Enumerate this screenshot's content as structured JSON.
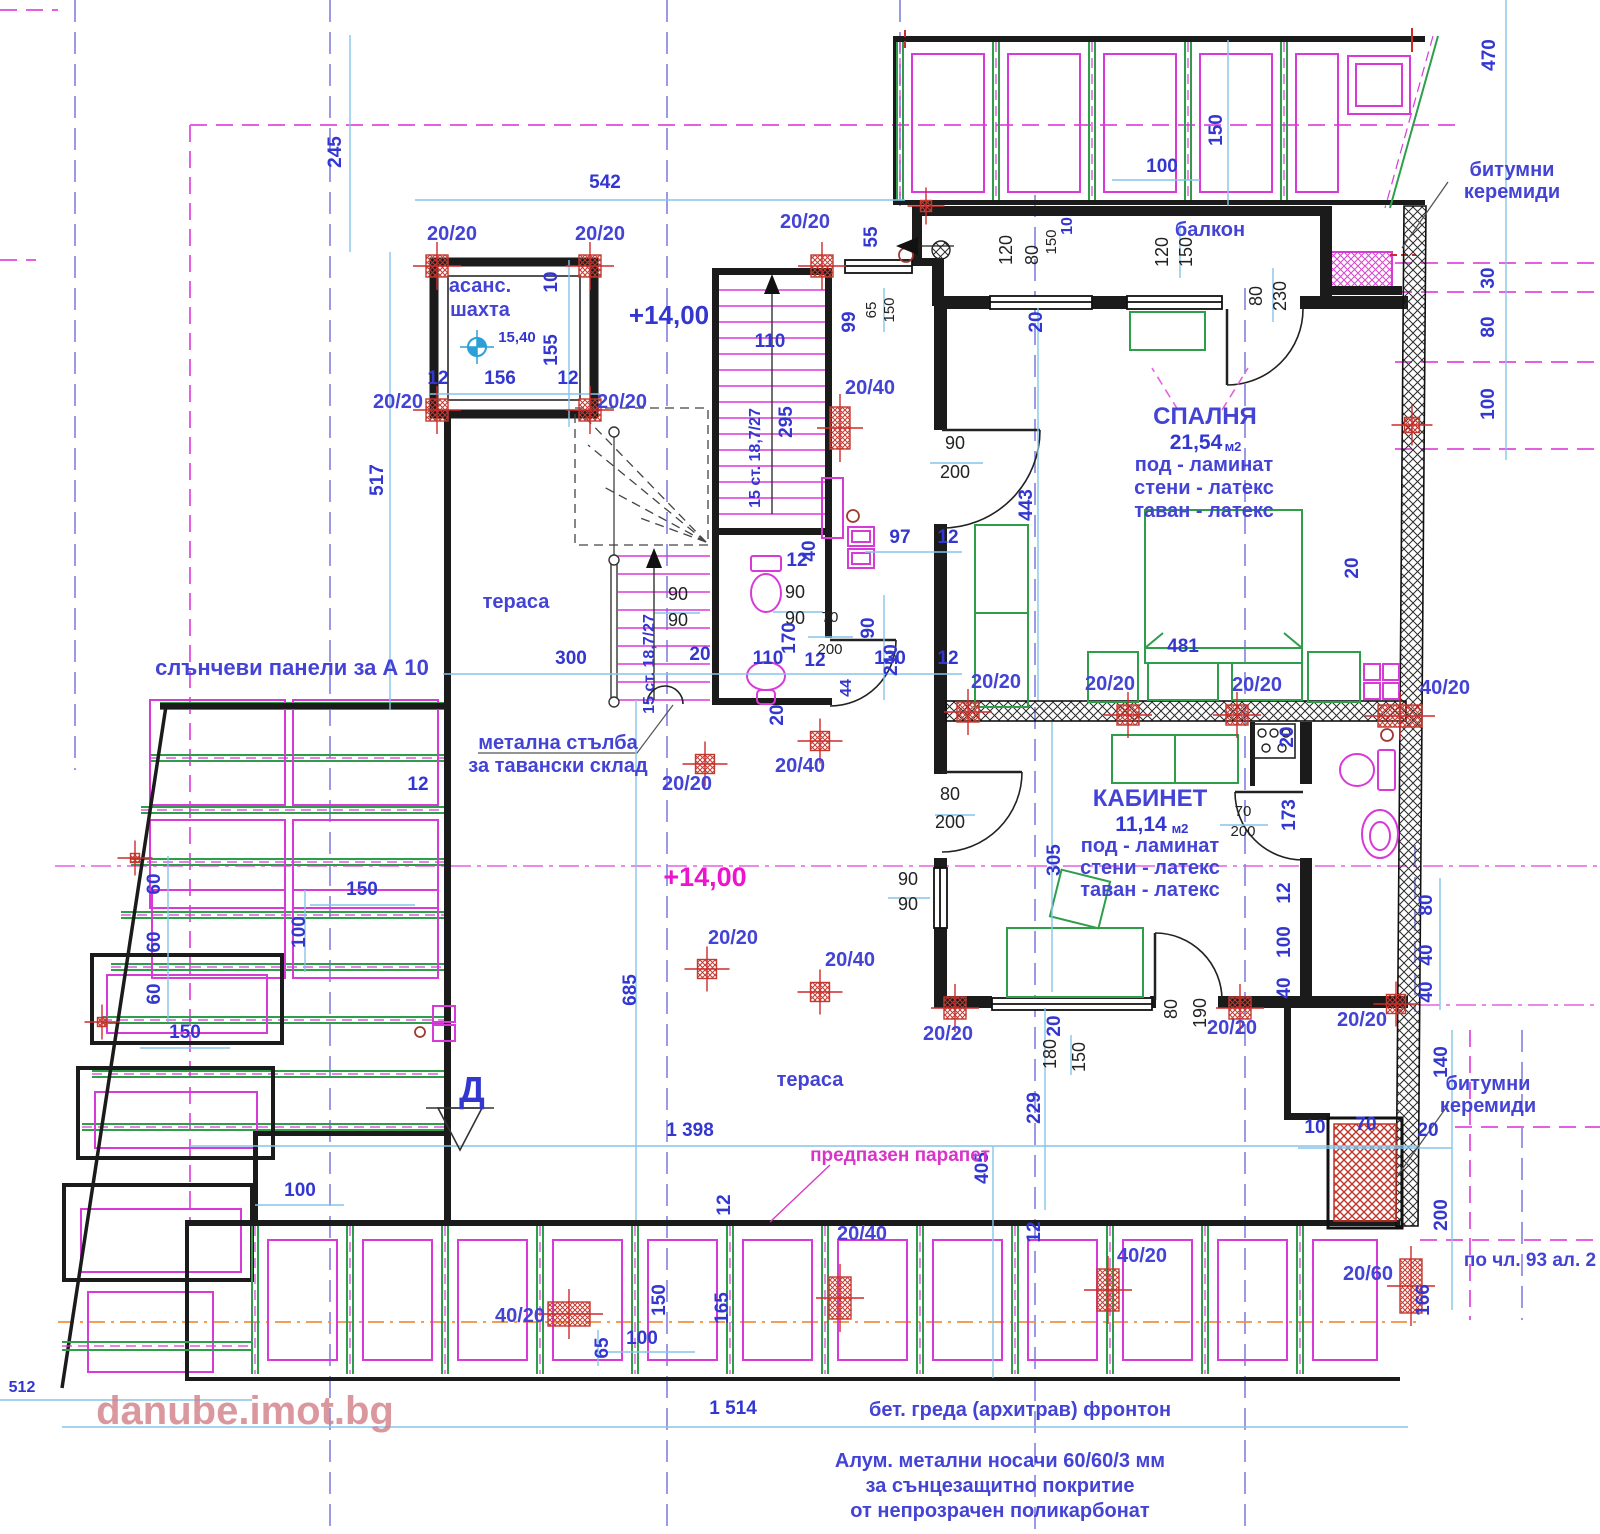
{
  "watermark": "danube.imot.bg",
  "labels": {
    "elevator1": "асанс.",
    "elevator2": "шахта",
    "balcony": "балкон",
    "terrace1": "тераса",
    "terrace2": "тераса",
    "solar": "слънчеви панели за А 10",
    "ladder1": "метална стълба",
    "ladder2": "за тавански склад",
    "parapet": "предпазен парапет",
    "section": "Д"
  },
  "levels": {
    "shaft": "15,40",
    "main": "+14,00",
    "terrace": "+14,00"
  },
  "rooms": [
    {
      "name": "СПАЛНЯ",
      "area": "21,54",
      "area_unit": "м2",
      "finishes": [
        "под - ламинат",
        "стени - латекс",
        "таван - латекс"
      ]
    },
    {
      "name": "КАБИНЕТ",
      "area": "11,14",
      "area_unit": "м2",
      "finishes": [
        "под - ламинат",
        "стени - латекс",
        "таван - латекс"
      ]
    }
  ],
  "stairs_note": "15 ст. 18,7/27",
  "notes": {
    "beam": "бет. греда (архитрав) фронтон",
    "alum": [
      "Алум. метални носачи 60/60/3 мм",
      "за сънцезащитно покритие",
      "от непрозрачен поликарбонат"
    ],
    "clause": "по чл. 93 ал. 2",
    "bitumen_top": [
      "битумни",
      "керемиди"
    ],
    "bitumen_bottom": [
      "битумни",
      "керемиди"
    ]
  },
  "colors": {
    "dim_text": "#3337d0",
    "dim_line": "#86c4ea",
    "wall": "#1b1b1b",
    "fixture_magenta": "#d83ad8",
    "furniture_green": "#2e9e4b",
    "column_red": "#cc2b2b",
    "axis_violet": "#8080e0",
    "boundary_magenta": "#e560e0",
    "level_magenta": "#ec14cc",
    "watermark_pink": "#d27f87",
    "orange_axis": "#f09040"
  },
  "texts": [
    {
      "t": "245",
      "x": 341,
      "y": 152,
      "c": "d",
      "r": 1
    },
    {
      "t": "542",
      "x": 605,
      "y": 188,
      "c": "d"
    },
    {
      "t": "20/20",
      "x": 452,
      "y": 240,
      "c": "b"
    },
    {
      "t": "20/20",
      "x": 600,
      "y": 240,
      "c": "b"
    },
    {
      "t": "20/20",
      "x": 805,
      "y": 228,
      "c": "b"
    },
    {
      "t": "55",
      "x": 877,
      "y": 237,
      "c": "d",
      "r": 1
    },
    {
      "t": "10",
      "x": 557,
      "y": 282,
      "c": "d",
      "r": 1
    },
    {
      "t": "155",
      "x": 557,
      "y": 350,
      "c": "d",
      "r": 1
    },
    {
      "t": "12",
      "x": 438,
      "y": 384,
      "c": "d"
    },
    {
      "t": "156",
      "x": 500,
      "y": 384,
      "c": "d"
    },
    {
      "t": "12",
      "x": 568,
      "y": 384,
      "c": "d"
    },
    {
      "t": "20/20",
      "x": 398,
      "y": 408,
      "c": "b"
    },
    {
      "t": "20/20",
      "x": 622,
      "y": 408,
      "c": "b"
    },
    {
      "t": "517",
      "x": 383,
      "y": 480,
      "c": "d",
      "r": 1
    },
    {
      "t": "110",
      "x": 770,
      "y": 347,
      "c": "d"
    },
    {
      "t": "295",
      "x": 792,
      "y": 422,
      "c": "d",
      "r": 1
    },
    {
      "t": "15 ст. 18,7/27",
      "x": 760,
      "y": 458,
      "c": "d2",
      "r": 1,
      "n": "stair-run-label"
    },
    {
      "t": "20/40",
      "x": 870,
      "y": 394,
      "c": "b"
    },
    {
      "t": "99",
      "x": 855,
      "y": 322,
      "c": "d",
      "r": 1
    },
    {
      "t": "65",
      "x": 876,
      "y": 310,
      "c": "k2",
      "r": 1
    },
    {
      "t": "150",
      "x": 894,
      "y": 310,
      "c": "k2",
      "r": 1
    },
    {
      "t": "120",
      "x": 1012,
      "y": 250,
      "c": "k",
      "r": 1
    },
    {
      "t": "80",
      "x": 1038,
      "y": 255,
      "c": "k",
      "r": 1
    },
    {
      "t": "150",
      "x": 1056,
      "y": 242,
      "c": "k2",
      "r": 1
    },
    {
      "t": "10",
      "x": 1072,
      "y": 226,
      "c": "d2",
      "r": 1
    },
    {
      "t": "20",
      "x": 1042,
      "y": 322,
      "c": "d",
      "r": 1
    },
    {
      "t": "120",
      "x": 1168,
      "y": 252,
      "c": "k",
      "r": 1
    },
    {
      "t": "150",
      "x": 1192,
      "y": 252,
      "c": "k",
      "r": 1
    },
    {
      "t": "80",
      "x": 1262,
      "y": 296,
      "c": "k",
      "r": 1
    },
    {
      "t": "230",
      "x": 1286,
      "y": 296,
      "c": "k",
      "r": 1
    },
    {
      "t": "150",
      "x": 1222,
      "y": 130,
      "c": "d",
      "r": 1
    },
    {
      "t": "100",
      "x": 1162,
      "y": 172,
      "c": "d"
    },
    {
      "t": "470",
      "x": 1495,
      "y": 55,
      "c": "d",
      "r": 1
    },
    {
      "t": "30",
      "x": 1494,
      "y": 278,
      "c": "d",
      "r": 1
    },
    {
      "t": "80",
      "x": 1494,
      "y": 327,
      "c": "d",
      "r": 1
    },
    {
      "t": "100",
      "x": 1494,
      "y": 404,
      "c": "d",
      "r": 1
    },
    {
      "t": "90",
      "x": 955,
      "y": 449,
      "c": "k"
    },
    {
      "t": "200",
      "x": 955,
      "y": 478,
      "c": "k"
    },
    {
      "t": "443",
      "x": 1032,
      "y": 505,
      "c": "d",
      "r": 1
    },
    {
      "t": "481",
      "x": 1183,
      "y": 652,
      "c": "d"
    },
    {
      "t": "97",
      "x": 900,
      "y": 543,
      "c": "d"
    },
    {
      "t": "12",
      "x": 948,
      "y": 543,
      "c": "d"
    },
    {
      "t": "130",
      "x": 890,
      "y": 664,
      "c": "d"
    },
    {
      "t": "12",
      "x": 948,
      "y": 664,
      "c": "d"
    },
    {
      "t": "90",
      "x": 874,
      "y": 628,
      "c": "d",
      "r": 1
    },
    {
      "t": "210",
      "x": 897,
      "y": 660,
      "c": "d",
      "r": 1
    },
    {
      "t": "20",
      "x": 1358,
      "y": 568,
      "c": "d",
      "r": 1
    },
    {
      "t": "20/20",
      "x": 996,
      "y": 688,
      "c": "b"
    },
    {
      "t": "20/20",
      "x": 1110,
      "y": 690,
      "c": "b"
    },
    {
      "t": "20/20",
      "x": 1257,
      "y": 691,
      "c": "b"
    },
    {
      "t": "40/20",
      "x": 1445,
      "y": 694,
      "c": "b"
    },
    {
      "t": "20",
      "x": 1293,
      "y": 737,
      "c": "d",
      "r": 1
    },
    {
      "t": "12",
      "x": 797,
      "y": 566,
      "c": "d"
    },
    {
      "t": "40",
      "x": 815,
      "y": 551,
      "c": "d",
      "r": 1
    },
    {
      "t": "90",
      "x": 678,
      "y": 600,
      "c": "k"
    },
    {
      "t": "90",
      "x": 678,
      "y": 626,
      "c": "k"
    },
    {
      "t": "90",
      "x": 795,
      "y": 598,
      "c": "k"
    },
    {
      "t": "90",
      "x": 795,
      "y": 624,
      "c": "k"
    },
    {
      "t": "15 ст. 18,7/27",
      "x": 654,
      "y": 664,
      "c": "d2",
      "r": 1,
      "n": "stair-run-label"
    },
    {
      "t": "300",
      "x": 571,
      "y": 664,
      "c": "d"
    },
    {
      "t": "110",
      "x": 768,
      "y": 664,
      "c": "d"
    },
    {
      "t": "12",
      "x": 815,
      "y": 666,
      "c": "d"
    },
    {
      "t": "44",
      "x": 851,
      "y": 688,
      "c": "d2",
      "r": 1
    },
    {
      "t": "170",
      "x": 795,
      "y": 638,
      "c": "d",
      "r": 1
    },
    {
      "t": "70",
      "x": 830,
      "y": 622,
      "c": "k2"
    },
    {
      "t": "200",
      "x": 830,
      "y": 654,
      "c": "k2"
    },
    {
      "t": "20",
      "x": 700,
      "y": 660,
      "c": "d"
    },
    {
      "t": "20",
      "x": 783,
      "y": 715,
      "c": "d",
      "r": 1
    },
    {
      "t": "305",
      "x": 1060,
      "y": 860,
      "c": "d",
      "r": 1
    },
    {
      "t": "70",
      "x": 1243,
      "y": 816,
      "c": "k2"
    },
    {
      "t": "200",
      "x": 1243,
      "y": 836,
      "c": "k2"
    },
    {
      "t": "173",
      "x": 1295,
      "y": 815,
      "c": "d",
      "r": 1
    },
    {
      "t": "80",
      "x": 950,
      "y": 800,
      "c": "k"
    },
    {
      "t": "200",
      "x": 950,
      "y": 828,
      "c": "k"
    },
    {
      "t": "90",
      "x": 908,
      "y": 885,
      "c": "k"
    },
    {
      "t": "90",
      "x": 908,
      "y": 910,
      "c": "k"
    },
    {
      "t": "12",
      "x": 1290,
      "y": 893,
      "c": "d",
      "r": 1
    },
    {
      "t": "100",
      "x": 1290,
      "y": 942,
      "c": "d",
      "r": 1
    },
    {
      "t": "40",
      "x": 1290,
      "y": 988,
      "c": "d",
      "r": 1
    },
    {
      "t": "80",
      "x": 1432,
      "y": 905,
      "c": "d",
      "r": 1
    },
    {
      "t": "40",
      "x": 1432,
      "y": 955,
      "c": "d",
      "r": 1
    },
    {
      "t": "40",
      "x": 1432,
      "y": 992,
      "c": "d",
      "r": 1
    },
    {
      "t": "20/20",
      "x": 948,
      "y": 1040,
      "c": "b"
    },
    {
      "t": "20/20",
      "x": 1232,
      "y": 1034,
      "c": "b"
    },
    {
      "t": "20/20",
      "x": 1362,
      "y": 1026,
      "c": "b"
    },
    {
      "t": "20",
      "x": 1060,
      "y": 1026,
      "c": "d",
      "r": 1
    },
    {
      "t": "180",
      "x": 1056,
      "y": 1054,
      "c": "k",
      "r": 1
    },
    {
      "t": "150",
      "x": 1085,
      "y": 1057,
      "c": "k",
      "r": 1
    },
    {
      "t": "80",
      "x": 1177,
      "y": 1009,
      "c": "k",
      "r": 1
    },
    {
      "t": "190",
      "x": 1206,
      "y": 1013,
      "c": "k",
      "r": 1
    },
    {
      "t": "60",
      "x": 160,
      "y": 884,
      "c": "d",
      "r": 1
    },
    {
      "t": "60",
      "x": 160,
      "y": 942,
      "c": "d",
      "r": 1
    },
    {
      "t": "60",
      "x": 160,
      "y": 994,
      "c": "d",
      "r": 1
    },
    {
      "t": "150",
      "x": 362,
      "y": 895,
      "c": "d"
    },
    {
      "t": "100",
      "x": 305,
      "y": 932,
      "c": "d",
      "r": 1
    },
    {
      "t": "150",
      "x": 185,
      "y": 1038,
      "c": "d"
    },
    {
      "t": "12",
      "x": 418,
      "y": 790,
      "c": "d"
    },
    {
      "t": "20/20",
      "x": 687,
      "y": 790,
      "c": "b"
    },
    {
      "t": "20/40",
      "x": 800,
      "y": 772,
      "c": "b"
    },
    {
      "t": "20/20",
      "x": 733,
      "y": 944,
      "c": "b"
    },
    {
      "t": "20/40",
      "x": 850,
      "y": 966,
      "c": "b"
    },
    {
      "t": "685",
      "x": 636,
      "y": 990,
      "c": "d",
      "r": 1
    },
    {
      "t": "1 398",
      "x": 690,
      "y": 1136,
      "c": "d"
    },
    {
      "t": "100",
      "x": 300,
      "y": 1196,
      "c": "d"
    },
    {
      "t": "405",
      "x": 988,
      "y": 1168,
      "c": "d",
      "r": 1
    },
    {
      "t": "229",
      "x": 1040,
      "y": 1108,
      "c": "d",
      "r": 1
    },
    {
      "t": "40/20",
      "x": 520,
      "y": 1322,
      "c": "b"
    },
    {
      "t": "65",
      "x": 608,
      "y": 1348,
      "c": "d",
      "r": 1
    },
    {
      "t": "100",
      "x": 642,
      "y": 1344,
      "c": "d"
    },
    {
      "t": "150",
      "x": 665,
      "y": 1300,
      "c": "d",
      "r": 1
    },
    {
      "t": "165",
      "x": 728,
      "y": 1308,
      "c": "d",
      "r": 1
    },
    {
      "t": "12",
      "x": 730,
      "y": 1205,
      "c": "d",
      "r": 1
    },
    {
      "t": "20/40",
      "x": 862,
      "y": 1240,
      "c": "b"
    },
    {
      "t": "40/20",
      "x": 1142,
      "y": 1262,
      "c": "b"
    },
    {
      "t": "20/60",
      "x": 1368,
      "y": 1280,
      "c": "b"
    },
    {
      "t": "12",
      "x": 1040,
      "y": 1232,
      "c": "d",
      "r": 1
    },
    {
      "t": "1 514",
      "x": 733,
      "y": 1414,
      "c": "d"
    },
    {
      "t": "512",
      "x": 22,
      "y": 1392,
      "c": "d2"
    },
    {
      "t": "10",
      "x": 1315,
      "y": 1133,
      "c": "d"
    },
    {
      "t": "70",
      "x": 1366,
      "y": 1130,
      "c": "d"
    },
    {
      "t": "20",
      "x": 1428,
      "y": 1136,
      "c": "d"
    },
    {
      "t": "140",
      "x": 1447,
      "y": 1062,
      "c": "d",
      "r": 1
    },
    {
      "t": "200",
      "x": 1447,
      "y": 1215,
      "c": "d",
      "r": 1
    },
    {
      "t": "166",
      "x": 1429,
      "y": 1300,
      "c": "d",
      "r": 1
    }
  ],
  "markers": [
    {
      "x": 437,
      "y": 266,
      "w": 22,
      "h": 22
    },
    {
      "x": 590,
      "y": 266,
      "w": 22,
      "h": 22
    },
    {
      "x": 437,
      "y": 410,
      "w": 22,
      "h": 22
    },
    {
      "x": 590,
      "y": 410,
      "w": 22,
      "h": 22
    },
    {
      "x": 822,
      "y": 266,
      "w": 22,
      "h": 22
    },
    {
      "x": 926,
      "y": 206,
      "w": 11,
      "h": 11
    },
    {
      "x": 840,
      "y": 428,
      "w": 20,
      "h": 42
    },
    {
      "x": 705,
      "y": 764,
      "w": 19,
      "h": 19
    },
    {
      "x": 820,
      "y": 741,
      "w": 19,
      "h": 19
    },
    {
      "x": 707,
      "y": 969,
      "w": 19,
      "h": 19
    },
    {
      "x": 820,
      "y": 992,
      "w": 19,
      "h": 19
    },
    {
      "x": 968,
      "y": 712,
      "w": 22,
      "h": 20
    },
    {
      "x": 1128,
      "y": 715,
      "w": 22,
      "h": 20
    },
    {
      "x": 1237,
      "y": 715,
      "w": 22,
      "h": 20
    },
    {
      "x": 1400,
      "y": 716,
      "w": 44,
      "h": 22
    },
    {
      "x": 1412,
      "y": 425,
      "w": 15,
      "h": 15
    },
    {
      "x": 955,
      "y": 1008,
      "w": 22,
      "h": 22
    },
    {
      "x": 1240,
      "y": 1008,
      "w": 22,
      "h": 22
    },
    {
      "x": 1396,
      "y": 1004,
      "w": 19,
      "h": 19
    },
    {
      "x": 569,
      "y": 1314,
      "w": 42,
      "h": 24
    },
    {
      "x": 840,
      "y": 1298,
      "w": 22,
      "h": 42
    },
    {
      "x": 1108,
      "y": 1290,
      "w": 22,
      "h": 42
    },
    {
      "x": 1411,
      "y": 1286,
      "w": 22,
      "h": 54
    },
    {
      "x": 135,
      "y": 858,
      "w": 9,
      "h": 9
    },
    {
      "x": 102,
      "y": 1022,
      "w": 9,
      "h": 9
    }
  ]
}
